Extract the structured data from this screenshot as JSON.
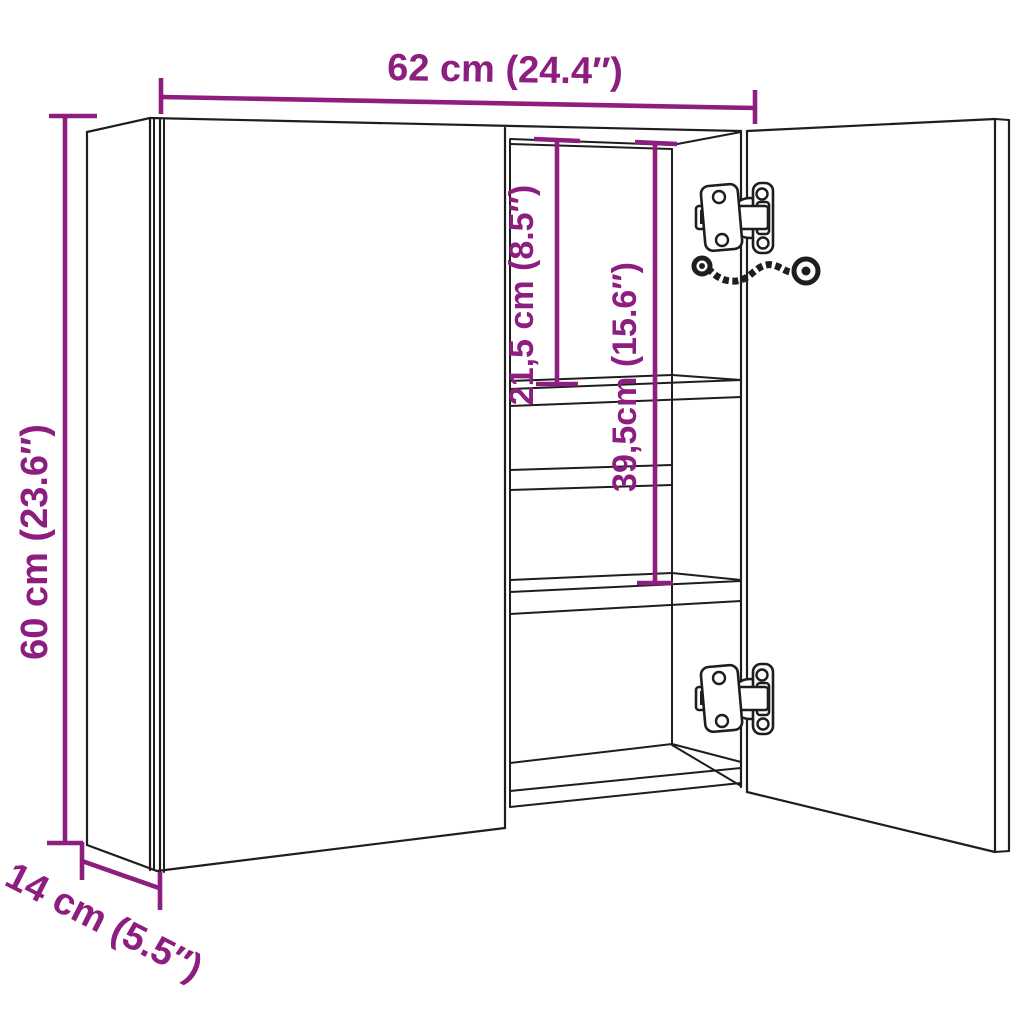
{
  "diagram": {
    "kind": "furniture-dimension-drawing",
    "subject": "two-door mirror cabinet, right door open, three interior compartments with two shelves and two concealed hinges",
    "dimensions": {
      "width": {
        "label": "62 cm (24.4″)",
        "orientation": "horizontal-top"
      },
      "height": {
        "label": "60 cm (23.6″)",
        "orientation": "vertical-left"
      },
      "depth": {
        "label": "14 cm (5.5″)",
        "orientation": "diagonal-bottom-left"
      },
      "top_compartment": {
        "label": "21,5 cm (8.5″)",
        "orientation": "vertical-interior"
      },
      "middle_compartment": {
        "label": "39,5cm (15.6″)",
        "orientation": "vertical-interior"
      }
    },
    "colors": {
      "dimension_accent": "#8e1d80",
      "line": "#1e1e1e",
      "background": "#ffffff"
    }
  }
}
